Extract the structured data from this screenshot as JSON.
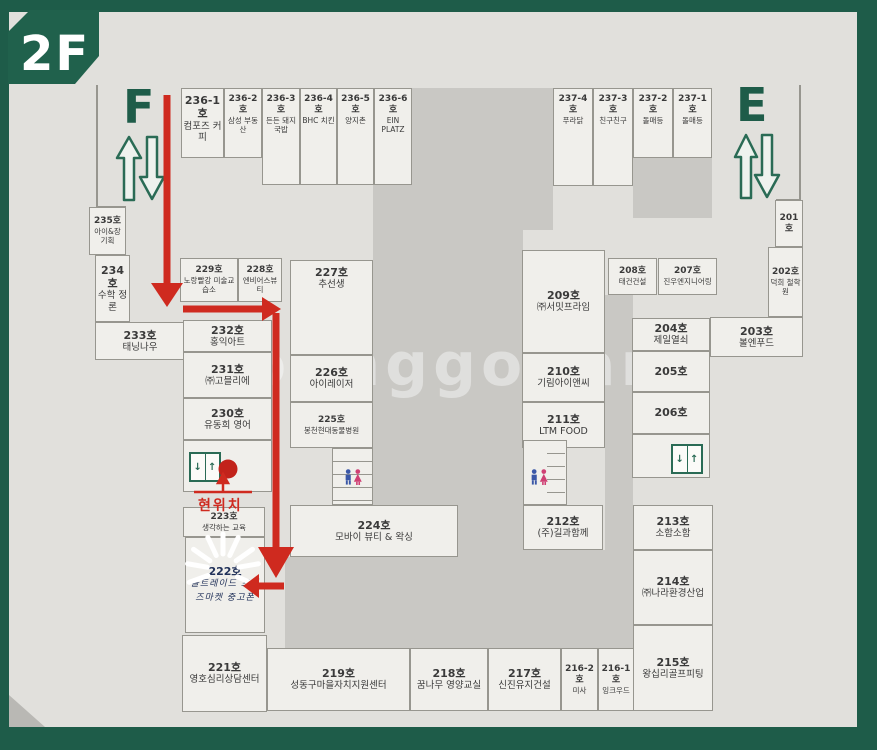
{
  "floor_label": "2F",
  "stairwells": [
    {
      "label": "F"
    },
    {
      "label": "E"
    }
  ],
  "current_location_label": "현위치",
  "watermark": "joonggonara",
  "rooms": [
    {
      "id": "236-1",
      "no": "236-1호",
      "name": "컴포즈 커피"
    },
    {
      "id": "236-2",
      "no": "236-2호",
      "name": "삼성 부동산"
    },
    {
      "id": "236-3",
      "no": "236-3호",
      "name": "든든 돼지국밥"
    },
    {
      "id": "236-4",
      "no": "236-4호",
      "name": "BHC 치킨"
    },
    {
      "id": "236-5",
      "no": "236-5호",
      "name": "양지촌"
    },
    {
      "id": "236-6",
      "no": "236-6호",
      "name": "EIN PLATZ"
    },
    {
      "id": "237-4",
      "no": "237-4호",
      "name": "푸라닭"
    },
    {
      "id": "237-3",
      "no": "237-3호",
      "name": "친구친구"
    },
    {
      "id": "237-2",
      "no": "237-2호",
      "name": "돌매등"
    },
    {
      "id": "237-1",
      "no": "237-1호",
      "name": "돌매등"
    },
    {
      "id": "235",
      "no": "235호",
      "name": "아이&장 기획"
    },
    {
      "id": "234",
      "no": "234호",
      "name": "수학 정론"
    },
    {
      "id": "233",
      "no": "233호",
      "name": "태닝나우"
    },
    {
      "id": "229",
      "no": "229호",
      "name": "노랑빨강 미술교습소"
    },
    {
      "id": "228",
      "no": "228호",
      "name": "엔비어스뷰티"
    },
    {
      "id": "232",
      "no": "232호",
      "name": "홍익아트"
    },
    {
      "id": "231",
      "no": "231호",
      "name": "㈜고믈리에"
    },
    {
      "id": "230",
      "no": "230호",
      "name": "유동희 영어"
    },
    {
      "id": "223",
      "no": "223호",
      "name": "생각하는 교육"
    },
    {
      "id": "222",
      "no": "222호",
      "name": "올트레이드 프렌즈마켓 중고폰"
    },
    {
      "id": "221",
      "no": "221호",
      "name": "영호심리상담센터"
    },
    {
      "id": "227",
      "no": "227호",
      "name": "추선생"
    },
    {
      "id": "226",
      "no": "226호",
      "name": "아이레이저"
    },
    {
      "id": "225",
      "no": "225호",
      "name": "봉천현대동물병원"
    },
    {
      "id": "224",
      "no": "224호",
      "name": "모바이 뷰티 & 왁싱"
    },
    {
      "id": "209",
      "no": "209호",
      "name": "㈜서밋프라임"
    },
    {
      "id": "210",
      "no": "210호",
      "name": "기림아이앤씨"
    },
    {
      "id": "211",
      "no": "211호",
      "name": "LTM FOOD"
    },
    {
      "id": "212",
      "no": "212호",
      "name": "(주)길과함께"
    },
    {
      "id": "208",
      "no": "208호",
      "name": "태건건설"
    },
    {
      "id": "207",
      "no": "207호",
      "name": "진우엔지니어링"
    },
    {
      "id": "204",
      "no": "204호",
      "name": "제일열쇠"
    },
    {
      "id": "205",
      "no": "205호",
      "name": ""
    },
    {
      "id": "206",
      "no": "206호",
      "name": ""
    },
    {
      "id": "213",
      "no": "213호",
      "name": "소함소함"
    },
    {
      "id": "214",
      "no": "214호",
      "name": "㈜나라환경산업"
    },
    {
      "id": "215",
      "no": "215호",
      "name": "왕십리골프피팅"
    },
    {
      "id": "201",
      "no": "201호",
      "name": ""
    },
    {
      "id": "202",
      "no": "202호",
      "name": "덕희 철학원"
    },
    {
      "id": "203",
      "no": "203호",
      "name": "볼엔푸드"
    },
    {
      "id": "219",
      "no": "219호",
      "name": "성동구마을자치지원센터"
    },
    {
      "id": "218",
      "no": "218호",
      "name": "꿈나무 영양교실"
    },
    {
      "id": "217",
      "no": "217호",
      "name": "신진유지건설"
    },
    {
      "id": "216-2",
      "no": "216-2호",
      "name": "미사"
    },
    {
      "id": "216-1",
      "no": "216-1호",
      "name": "잉크우드"
    }
  ]
}
